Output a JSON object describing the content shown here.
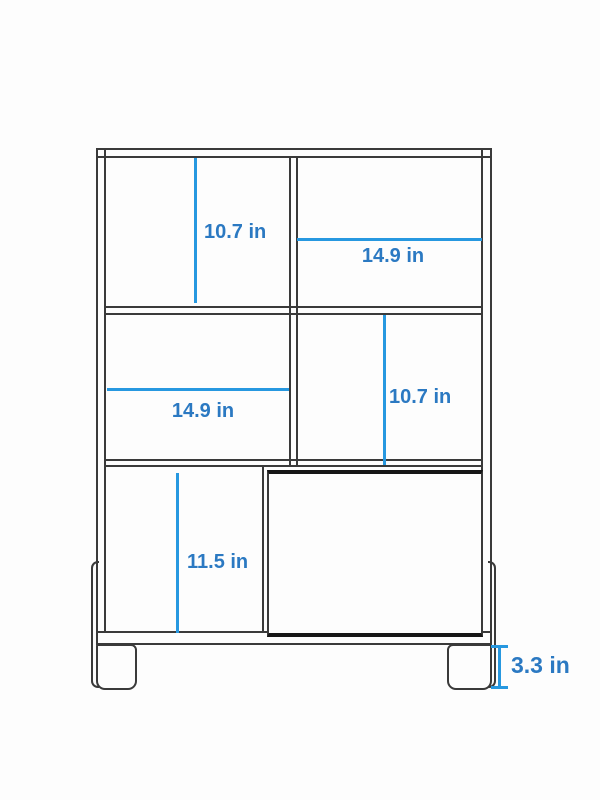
{
  "diagram": {
    "kind": "furniture-dimension-diagram",
    "subject": "storage cabinet with two shelf rows, open cubbies, sliding door panel and legs",
    "unit": "in",
    "colors": {
      "dimension_line": "#2798e0",
      "dimension_text": "#2b79c2",
      "outline": "#3a3a3a",
      "door_outline": "#161616",
      "background": "#fdfdfd"
    },
    "dimensions": [
      {
        "id": "top-left-compartment-height",
        "label": "10.7 in",
        "orientation": "vertical",
        "region": "top-left-compartment"
      },
      {
        "id": "top-right-compartment-width",
        "label": "14.9 in",
        "orientation": "horizontal",
        "region": "top-right-compartment"
      },
      {
        "id": "middle-left-compartment-width",
        "label": "14.9 in",
        "orientation": "horizontal",
        "region": "middle-left-compartment"
      },
      {
        "id": "middle-right-compartment-height",
        "label": "10.7 in",
        "orientation": "vertical",
        "region": "middle-right-compartment"
      },
      {
        "id": "bottom-left-compartment-height",
        "label": "11.5 in",
        "orientation": "vertical",
        "region": "bottom-left-compartment"
      },
      {
        "id": "leg-height",
        "label": "3.3 in",
        "orientation": "vertical",
        "region": "leg"
      }
    ]
  }
}
